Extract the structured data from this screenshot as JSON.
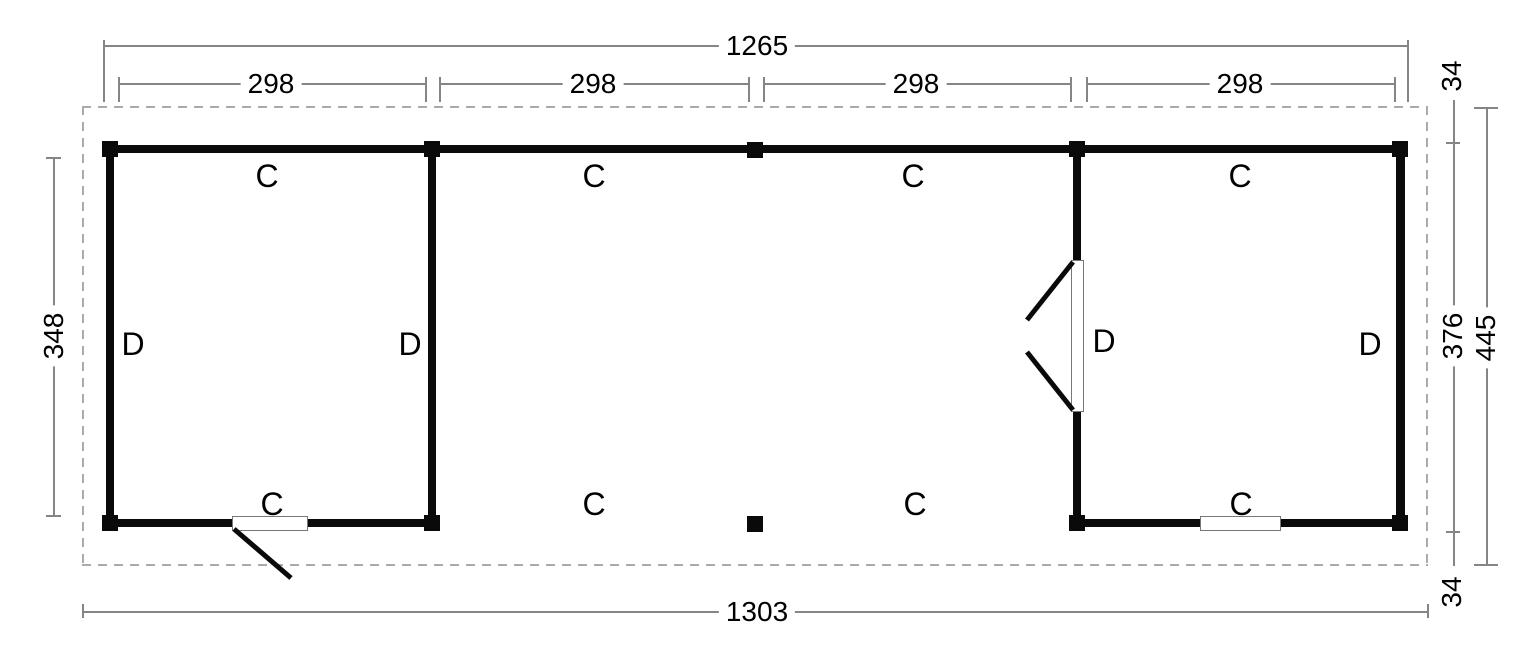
{
  "dimensions": {
    "width_posts": "1265",
    "bays": [
      "298",
      "298",
      "298",
      "298"
    ],
    "width_total": "1303",
    "depth_left_inner": "348",
    "overhang_top": "34",
    "depth_posts": "376",
    "depth_total": "445",
    "overhang_bottom": "34"
  },
  "labels": {
    "top_row": [
      "C",
      "C",
      "C",
      "C"
    ],
    "bottom_row": [
      "C",
      "C",
      "C",
      "C"
    ],
    "side": [
      "D",
      "D",
      "D",
      "D"
    ]
  },
  "colors": {
    "wall": "#0a0a0a",
    "dimension_line": "#858585",
    "dashed_outline": "#ababab",
    "opening_outline": "#777777",
    "text": "#000000",
    "background": "#ffffff"
  }
}
